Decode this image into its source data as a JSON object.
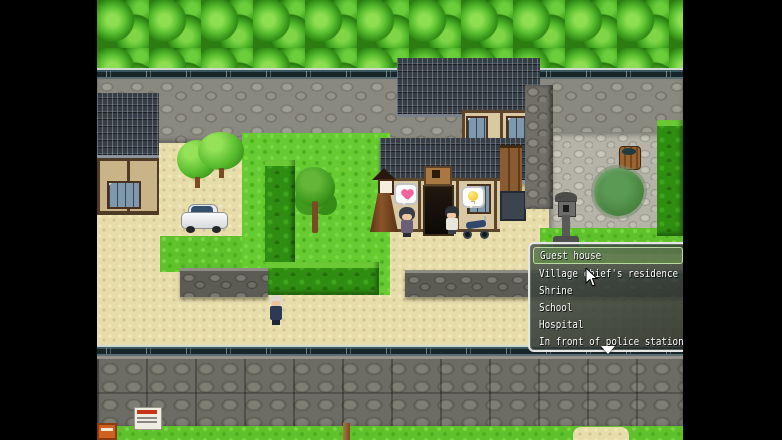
{
  "screen": {
    "width": 782,
    "height": 440,
    "letterbox_color": "#000000"
  },
  "choice_menu": {
    "items": [
      "Guest house",
      "Village chief's residence",
      "Shrine",
      "School",
      "Hospital",
      "In front of police station"
    ],
    "selected_index": 0,
    "selected_item": "Guest house",
    "has_more_below": true,
    "scroll_indicator_icon": "down-arrow-icon"
  },
  "scene": {
    "npcs": [
      {
        "name": "villager-woman",
        "bubble_icon": "heart-icon"
      },
      {
        "name": "villager-man",
        "bubble_icon": "lightbulb-icon"
      },
      {
        "name": "old-man-walking",
        "bubble_icon": null
      }
    ],
    "vehicles": [
      "white-car",
      "motorcycle"
    ],
    "landmarks": [
      "japanese-inn",
      "left-house",
      "stone-lantern",
      "wooden-shrine-lantern",
      "courtyard-pond",
      "water-barrel",
      "notice-poster",
      "hedge-maze",
      "forest",
      "stone-walls"
    ]
  },
  "colors": {
    "menu_border": "#e4e6e4",
    "menu_background": "rgba(40,48,42,0.85)",
    "menu_selection": "#8db36a",
    "menu_text": "#ffffff",
    "grass": "#5fc12c",
    "sand_path": "#e7ddab",
    "cobblestone": "#8a897f",
    "roof_tile": "#363d45",
    "heart_bubble": "#f2649a",
    "lightbulb_bubble": "#f5c827"
  }
}
